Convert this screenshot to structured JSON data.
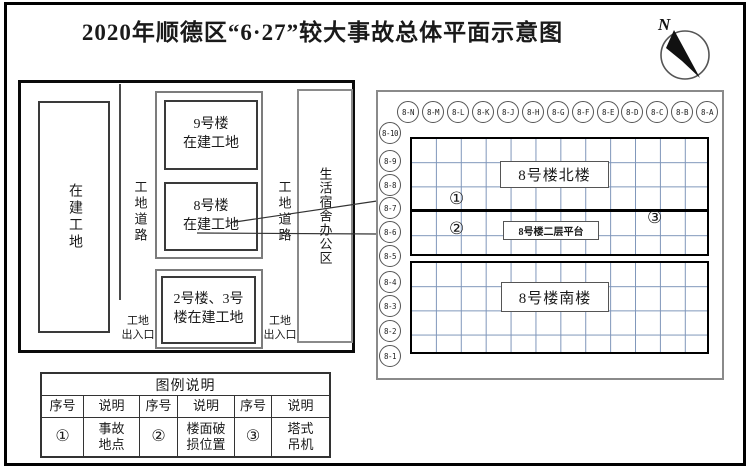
{
  "title": "2020年顺德区“6·27”较大事故总体平面示意图",
  "compass": {
    "label": "N"
  },
  "site_plan": {
    "left_zone": "在建工地",
    "road_left": "工地道路",
    "road_right": "工地道路",
    "building9": "9号楼\n在建工地",
    "building8": "8号楼\n在建工地",
    "building23": "2号楼、3号\n楼在建工地",
    "living_area": "生活宿舍办公区",
    "entrance_left": "工地\n出入口",
    "entrance_right": "工地\n出入口"
  },
  "grid_panel": {
    "col_axes": [
      "8-N",
      "8-M",
      "8-L",
      "8-K",
      "8-J",
      "8-H",
      "8-G",
      "8-F",
      "8-E",
      "8-D",
      "8-C",
      "8-B",
      "8-A"
    ],
    "row_axes": [
      "8-10",
      "8-9",
      "8-8",
      "8-7",
      "8-6",
      "8-5",
      "8-4",
      "8-3",
      "8-2",
      "8-1"
    ],
    "north_label": "8号楼北楼",
    "platform_label": "8号楼二层平台",
    "south_label": "8号楼南楼",
    "marker1": "①",
    "marker2": "②",
    "marker3": "③",
    "grid_line_color": "#7f96ba"
  },
  "legend": {
    "title": "图例说明",
    "col_headers": [
      "序号",
      "说明",
      "序号",
      "说明",
      "序号",
      "说明"
    ],
    "row": [
      "①",
      "事故\n地点",
      "②",
      "楼面破\n损位置",
      "③",
      "塔式\n吊机"
    ]
  }
}
